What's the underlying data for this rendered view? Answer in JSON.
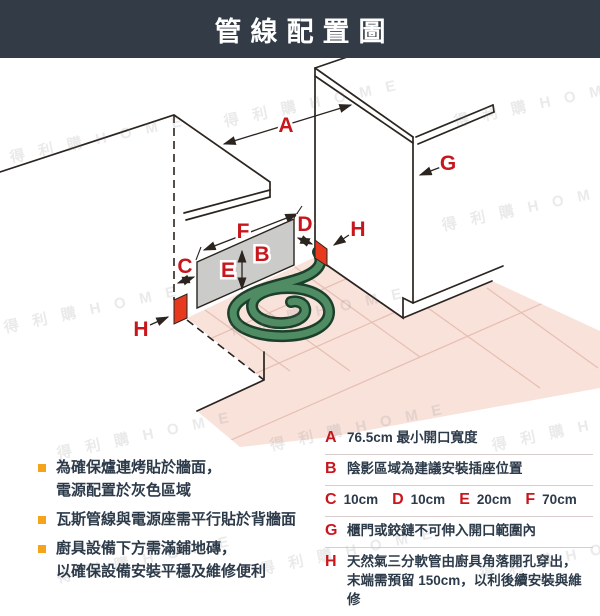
{
  "header": {
    "title": "管線配置圖"
  },
  "watermark": "得 利 購  H O M E",
  "colors": {
    "header_bg": "#333b46",
    "accent_red": "#c8161d",
    "marker_red": "#e6391e",
    "panel_gray": "#cbcbca",
    "hose_green_body": "#4f8c63",
    "hose_green_outline": "#1c3f2b",
    "floor_pink": "#f8e2da",
    "tile_line": "#e7beb2",
    "bullet_orange": "#f6a31c",
    "text_dark": "#2c3a49"
  },
  "diagram": {
    "labels": {
      "a": "A",
      "b": "B",
      "c": "C",
      "d": "D",
      "e": "E",
      "f": "F",
      "g": "G",
      "h": "H"
    }
  },
  "notes": [
    {
      "line1": "為確保爐連烤貼於牆面，",
      "line2": "電源配置於灰色區域"
    },
    {
      "line1": "瓦斯管線與電源座需平行貼於背牆面",
      "line2": ""
    },
    {
      "line1": "廚具設備下方需滿鋪地磚，",
      "line2": "以確保設備安裝平穩及維修便利"
    }
  ],
  "legend": {
    "rows": [
      {
        "letter": "A",
        "text": "76.5cm 最小開口寬度"
      },
      {
        "letter": "B",
        "text": "陰影區域為建議安裝插座位置"
      },
      {
        "letter": "G",
        "text": "櫃門或鉸鏈不可伸入開口範圍內"
      },
      {
        "letter": "H",
        "text": "天然氣三分軟管由廚具角落開孔穿出，",
        "text2": "末端需預留 150cm，以利後續安裝與維修"
      }
    ],
    "dims": [
      {
        "letter": "C",
        "value": "10cm"
      },
      {
        "letter": "D",
        "value": "10cm"
      },
      {
        "letter": "E",
        "value": "20cm"
      },
      {
        "letter": "F",
        "value": "70cm"
      }
    ]
  }
}
